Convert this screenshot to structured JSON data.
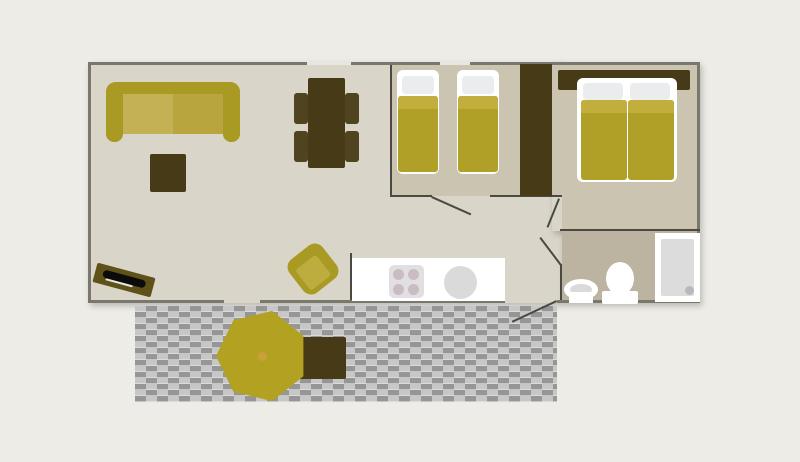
{
  "colors": {
    "background": "#edece6",
    "floor_living": "#d9d5c9",
    "floor_bedroom": "#cbc4b1",
    "floor_bathroom": "#bcb4a0",
    "wall_outer": "#7a776d",
    "wall_inner": "#4b4942",
    "window_fill": "#e8e6df",
    "furniture_dark": "#473a17",
    "olive": "#a89a23",
    "cushion_left": "#c4b055",
    "cushion_right": "#b9a53e",
    "blanket": "#b1a027",
    "blanket_fold": "#c1ae3c",
    "pillow": "#ebecee",
    "deck_dark": "#969696",
    "deck_light": "#c7c7c7",
    "stove_plate": "#e2dfe3",
    "burner": "#c9bcc3",
    "sink_gray": "#dadada",
    "shower_inner": "#dcdcdc",
    "drain": "#b9b9b9",
    "parasol": "#b3a122",
    "parasol_pole": "#c9a039",
    "tv_frame": "#5e5218",
    "tv_screen": "#0b0b0b",
    "chair": "#50431f"
  },
  "plan": {
    "rooms": [
      {
        "name": "living-room"
      },
      {
        "name": "single-bedroom"
      },
      {
        "name": "double-bedroom"
      },
      {
        "name": "bathroom"
      },
      {
        "name": "kitchen"
      },
      {
        "name": "deck"
      }
    ],
    "furniture": [
      "sofa",
      "coffee-table",
      "tv",
      "dining-table",
      "dining-chair",
      "armchair",
      "single-bed",
      "single-bed",
      "wardrobe",
      "headboard",
      "double-bed",
      "washbasin",
      "toilet",
      "shower",
      "kitchen-counter",
      "stove",
      "kitchen-sink",
      "parasol",
      "patio-table"
    ]
  }
}
